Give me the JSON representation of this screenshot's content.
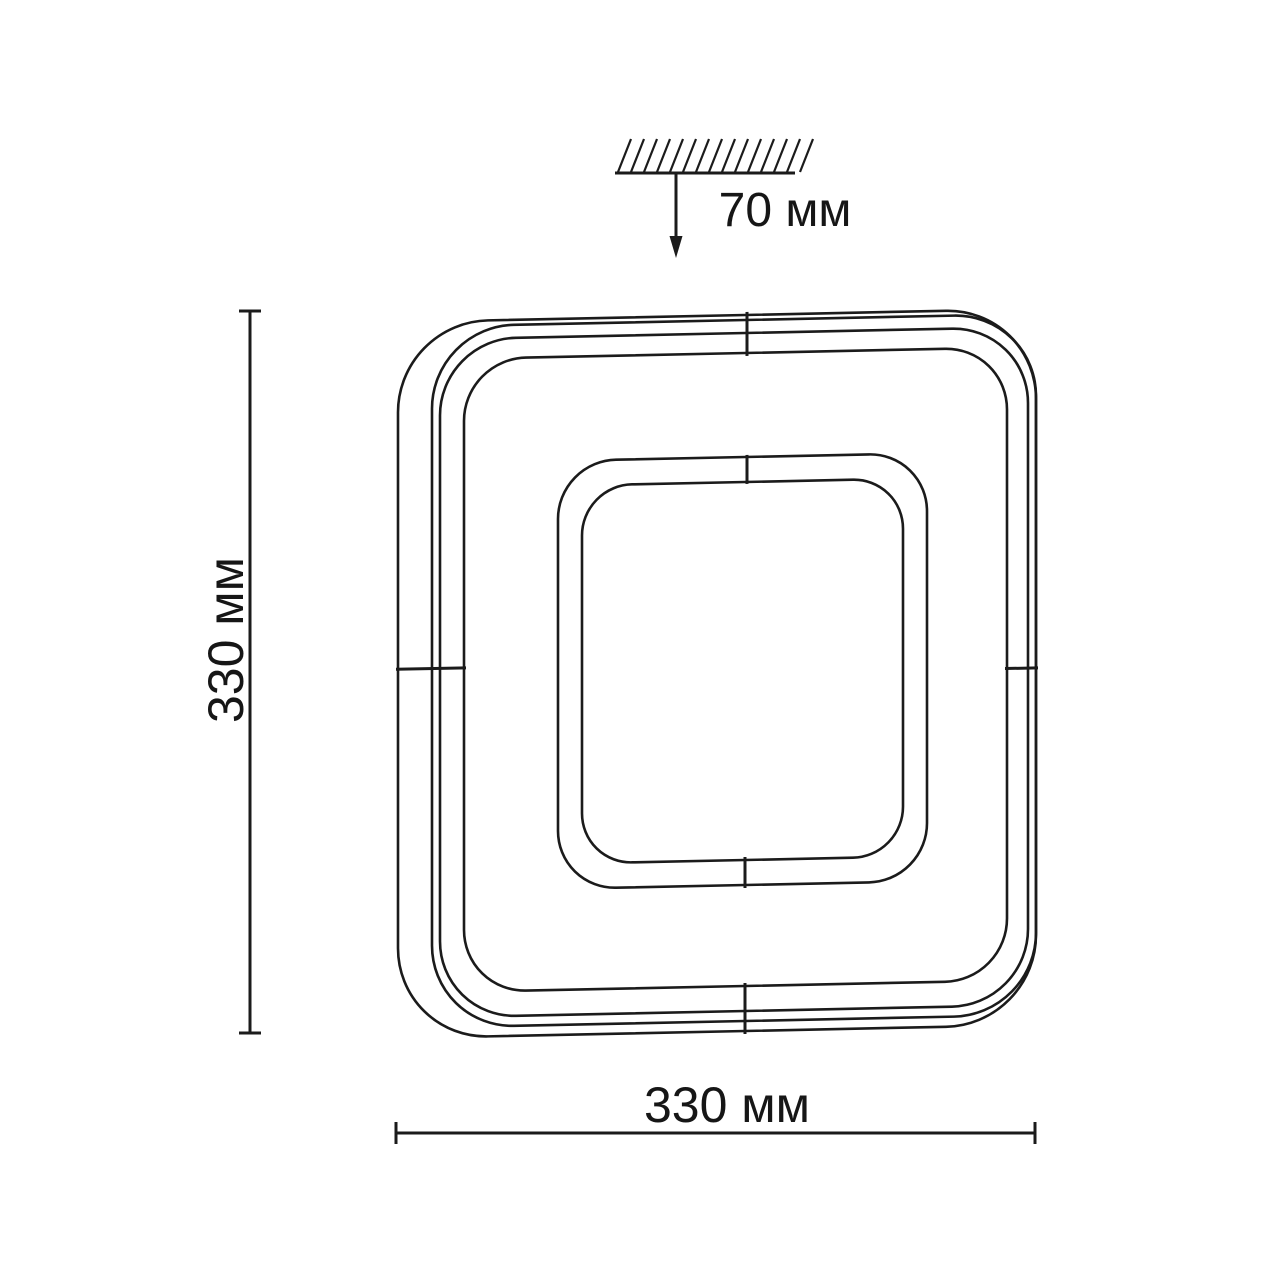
{
  "page": {
    "background_color": "#ffffff",
    "line_color": "#1b1b1b",
    "text_color": "#161616"
  },
  "diagram": {
    "type": "technical-dimension-drawing",
    "subject": "square LED ceiling light fixture, front view with nested rounded-square outlines and ceiling mounting symbol",
    "labels": {
      "depth": "70 мм",
      "height": "330 мм",
      "width": "330 мм"
    },
    "dimensions_mm": {
      "width": 330,
      "height": 330,
      "depth": 70
    },
    "symbols": {
      "ceiling": "hatched-surface",
      "depth_pointer": "down-arrow"
    }
  }
}
